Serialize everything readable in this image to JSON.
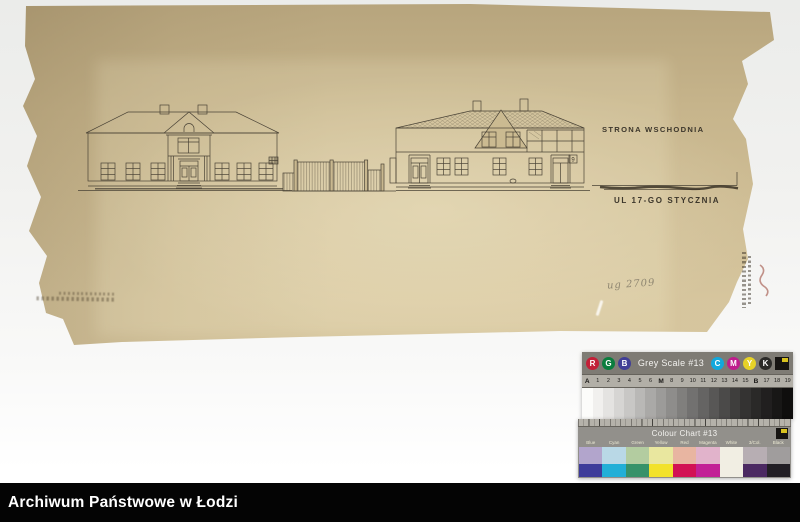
{
  "archive_bar": {
    "title": "Archiwum Państwowe w Łodzi"
  },
  "drawing": {
    "side_label": "STRONA WSCHODNIA",
    "street_label": "UL 17-GO STYCZNIA",
    "pencil_note": "ug 2709",
    "house_number": "9",
    "paper_color": "#c7b58c",
    "ink_color": "#4a4336"
  },
  "calibration": {
    "grey_scale": {
      "title": "Grey Scale #13",
      "left_circles": [
        {
          "letter": "R",
          "color": "#c22038"
        },
        {
          "letter": "G",
          "color": "#0b7d3e"
        },
        {
          "letter": "B",
          "color": "#413e96"
        }
      ],
      "right_circles": [
        {
          "letter": "C",
          "color": "#12a8dc"
        },
        {
          "letter": "M",
          "color": "#bf1d8d"
        },
        {
          "letter": "Y",
          "color": "#e6d227"
        },
        {
          "letter": "K",
          "color": "#2b2a28"
        }
      ],
      "tick_labels": [
        "A",
        "1",
        "2",
        "3",
        "4",
        "5",
        "6",
        "M",
        "8",
        "9",
        "10",
        "11",
        "12",
        "13",
        "14",
        "15",
        "B",
        "17",
        "18",
        "19"
      ],
      "steps": [
        "#fcfcfa",
        "#f1f0ee",
        "#e4e3e1",
        "#d6d5d3",
        "#c8c7c5",
        "#b9b8b6",
        "#aaa9a7",
        "#9c9b99",
        "#8e8d8b",
        "#807f7d",
        "#727170",
        "#656463",
        "#585756",
        "#4b4a49",
        "#3f3e3d",
        "#343332",
        "#2a2928",
        "#211f1f",
        "#181716",
        "#0f0e0d"
      ]
    },
    "colour_chart": {
      "title": "Colour Chart #13",
      "columns": [
        {
          "label": "Blue",
          "top": "#b2a5cc",
          "bottom": "#3e3c9a"
        },
        {
          "label": "Cyan",
          "top": "#b9d8e6",
          "bottom": "#22afd7"
        },
        {
          "label": "Green",
          "top": "#b3cca0",
          "bottom": "#37926a"
        },
        {
          "label": "Yellow",
          "top": "#e9e79f",
          "bottom": "#f2e22b"
        },
        {
          "label": "Red",
          "top": "#e8b5a1",
          "bottom": "#d21154"
        },
        {
          "label": "Magenta",
          "top": "#e1b3cb",
          "bottom": "#c22096"
        },
        {
          "label": "White",
          "top": "#f1eee3",
          "bottom": "#f1eee3",
          "single": true
        },
        {
          "label": "3/Col.",
          "top": "#b7aeb3",
          "bottom": "#4b2962"
        },
        {
          "label": "Black",
          "top": "#a09d9d",
          "bottom": "#221f25"
        }
      ]
    }
  }
}
